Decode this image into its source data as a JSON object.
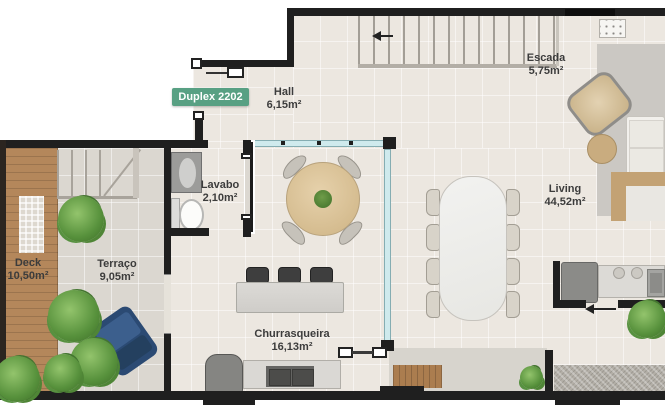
{
  "badge": {
    "label": "Duplex 2202"
  },
  "rooms": {
    "escada": {
      "name": "Escada",
      "area": "5,75m²"
    },
    "hall": {
      "name": "Hall",
      "area": "6,15m²"
    },
    "lavabo": {
      "name": "Lavabo",
      "area": "2,10m²"
    },
    "deck": {
      "name": "Deck",
      "area": "10,50m²"
    },
    "terraco": {
      "name": "Terraço",
      "area": "9,05m²"
    },
    "churrasqueira": {
      "name": "Churrasqueira",
      "area": "16,13m²"
    },
    "living": {
      "name": "Living",
      "area": "44,52m²"
    }
  },
  "colors": {
    "wall": "#1f1f1f",
    "floor": "#ece7e0",
    "terrace": "#dbd7d0",
    "deck_wood": "#b4875b",
    "glass": "#cfeaed",
    "badge_green": "#58a083",
    "plant_green": "#57913c",
    "lounge_chair_blue": "#2b4a73",
    "marble": "#f2f2f0"
  }
}
